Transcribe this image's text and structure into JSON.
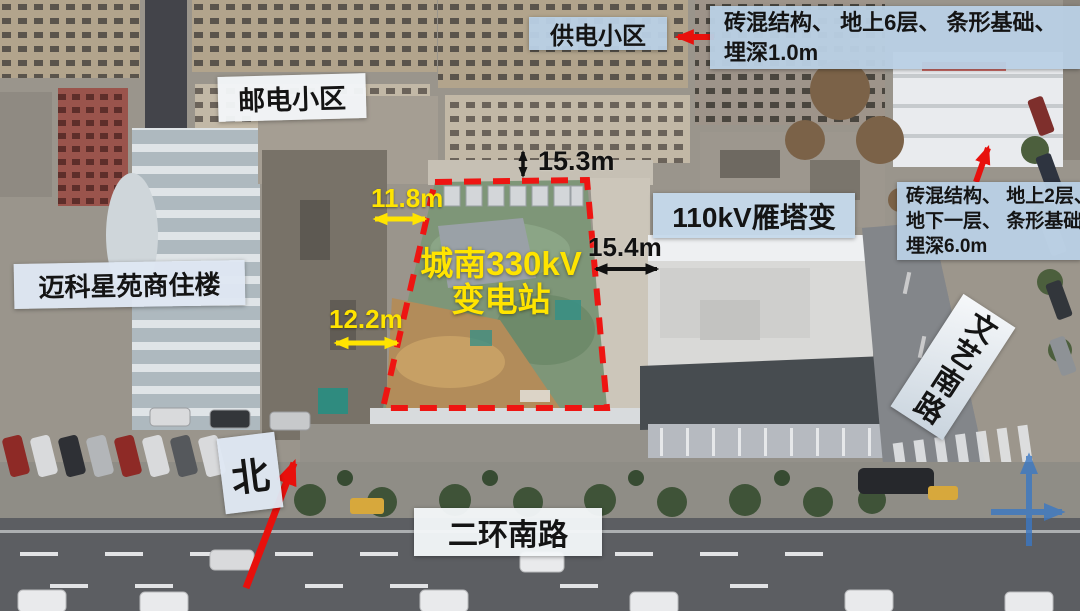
{
  "figure": {
    "site_label": {
      "line1": "城南330kV",
      "line2": "变电站"
    }
  },
  "labels": {
    "power_supply_block": "供电小区",
    "post_telecom_block": "邮电小区",
    "maike_residence": "迈科星苑商住楼",
    "yanta_110kv": "110kV雁塔变",
    "wenyi_south_road": "文艺南路",
    "second_ring_south_road": "二环南路",
    "north": "北"
  },
  "annotations": {
    "top_right_note": {
      "line1": "砖混结构、 地上6层、 条形基础、",
      "line2": "埋深1.0m"
    },
    "right_note": {
      "line1": "砖混结构、 地上2层、",
      "line2": "地下一层、 条形基础、",
      "line3": "埋深6.0m"
    }
  },
  "dimensions": {
    "north_offset": "15.3m",
    "west_offset_upper": "11.8m",
    "east_offset": "15.4m",
    "west_offset_lower": "12.2m"
  },
  "colors": {
    "boundary_red": "#ee1512",
    "annotation_red": "#e8100c",
    "dimension_yellow": "#ffe400",
    "dimension_black": "#111111",
    "axes_blue": "#3b78c4",
    "label_bg_blue": "#b9cfe4",
    "site_label_yellow": "#ffe400"
  }
}
